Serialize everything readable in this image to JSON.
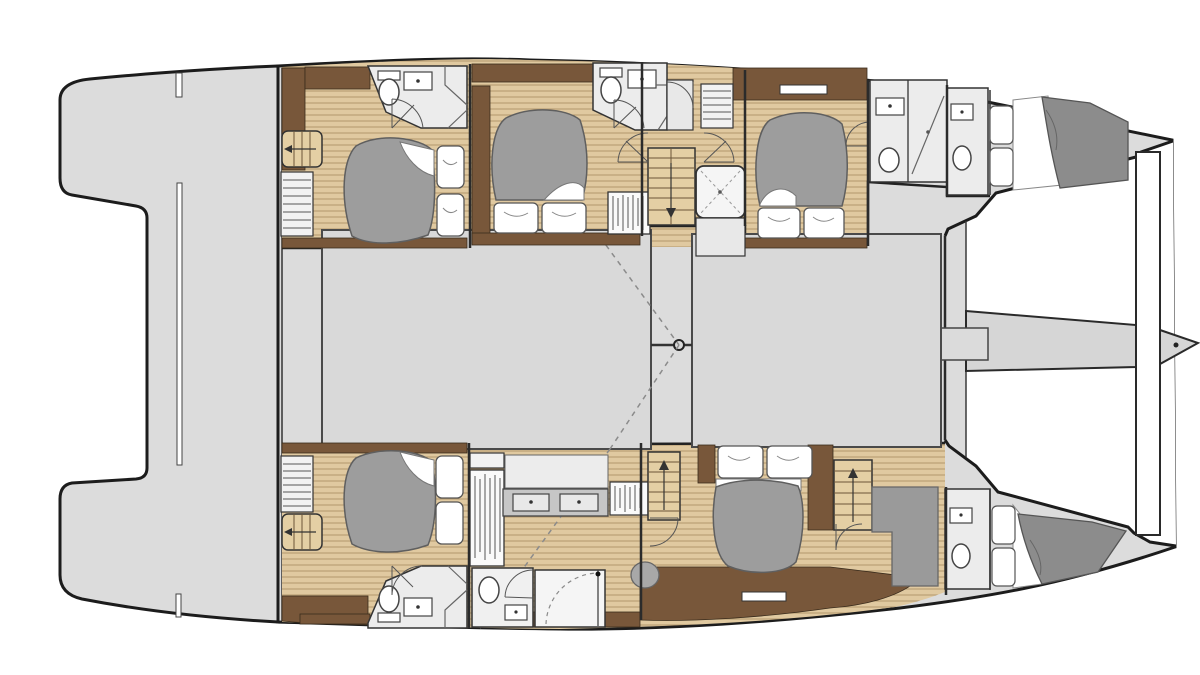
{
  "title": "catamaran-deck-plan",
  "colors": {
    "outline": "#1c1c1c",
    "wall": "#2e2e2e",
    "deck": "#dcdcdc",
    "saloon": "#d9d9d9",
    "wood": "#e0c9a0",
    "wood_line": "#b2966b",
    "trim_brown": "#78573a",
    "stair": "#e4cfa4",
    "bed_duvet": "#9d9d9d",
    "bed_duvet_dark": "#8c8c8c",
    "bath_floor": "#ececec",
    "counter": "#c6c6c6",
    "fixture": "#ffffff",
    "dashed": "#8b8b8b"
  },
  "plan": {
    "vessel": "catamaran",
    "view": "top-down interior deck plan",
    "areas": [
      {
        "name": "aft-deck",
        "features": [
          "port-swim-platform",
          "starboard-swim-platform",
          "tender-recess",
          "deck-hatch-slits"
        ]
      },
      {
        "name": "port-aft-cabin",
        "features": [
          "double-bed",
          "pillows",
          "steps",
          "shelf-unit",
          "ensuite-toilet",
          "ensuite-sink",
          "shower"
        ]
      },
      {
        "name": "port-mid-cabin",
        "features": [
          "double-bed",
          "pillows",
          "wardrobe",
          "ensuite-toilet",
          "ensuite-sink",
          "shower"
        ]
      },
      {
        "name": "port-companionway",
        "features": [
          "staircase-down",
          "shower-cubicle",
          "folding-doors"
        ]
      },
      {
        "name": "port-forward-cabin",
        "features": [
          "double-bed",
          "pillows",
          "vent-hatch",
          "ensuite-toilet",
          "ensuite-sink",
          "shower"
        ]
      },
      {
        "name": "port-bow-cabin",
        "features": [
          "berth",
          "pillows",
          "toilet",
          "sink"
        ]
      },
      {
        "name": "saloon-coachroof",
        "features": [
          "port-block",
          "starboard-block",
          "center-corridor",
          "mast-ring",
          "mast-beam",
          "rigging-dashed-lines"
        ]
      },
      {
        "name": "foredeck",
        "features": [
          "forward-crossbeam",
          "aft-crossbeam",
          "bowsprit-longeron",
          "bowsprit-tip",
          "anchor-fitting"
        ]
      },
      {
        "name": "starboard-aft-cabin",
        "features": [
          "double-bed",
          "pillows",
          "steps",
          "shelf-unit",
          "ensuite-toilet",
          "ensuite-sink",
          "shower"
        ]
      },
      {
        "name": "starboard-mid-area",
        "features": [
          "hanging-locker",
          "vanity-twin-sinks",
          "toilet-room",
          "shower-room",
          "entry-door"
        ]
      },
      {
        "name": "starboard-owner-cabin",
        "features": [
          "double-bed",
          "pillows",
          "staircase-up-left",
          "staircase-up-right",
          "pouf",
          "l-shaped-desk",
          "vent-hatch"
        ]
      },
      {
        "name": "starboard-bow-cabin",
        "features": [
          "berth",
          "pillows",
          "toilet",
          "sink"
        ]
      }
    ]
  }
}
